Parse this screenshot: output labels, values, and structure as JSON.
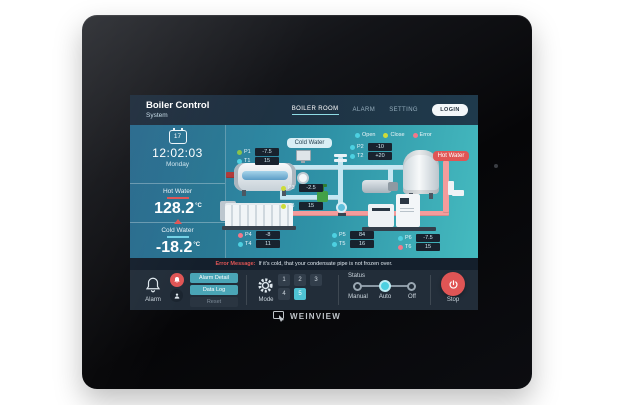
{
  "brand": {
    "logo_text": "WEINVIEW"
  },
  "header": {
    "title": "Boiler Control",
    "subtitle": "System",
    "nav": [
      {
        "label": "BOILER ROOM"
      },
      {
        "label": "ALARM"
      },
      {
        "label": "SETTING"
      }
    ],
    "login_label": "LOGIN"
  },
  "sidebar": {
    "calendar_day": "17",
    "time": "12:02:03",
    "weekday": "Monday",
    "hot_water": {
      "label": "Hot Water",
      "value": "128.2",
      "unit": "°C"
    },
    "cold_water": {
      "label": "Cold Water",
      "value": "-18.2",
      "unit": "°C"
    }
  },
  "diagram": {
    "legend": [
      {
        "label": "Open",
        "color": "#4dd0e1"
      },
      {
        "label": "Close",
        "color": "#cddc39"
      },
      {
        "label": "Error",
        "color": "#f2788a"
      }
    ],
    "pipe_labels": {
      "cold": "Cold Water",
      "hot": "Hot Water"
    },
    "sensors": [
      {
        "id": "P1",
        "value": "-7.5",
        "color": "#8bc34a"
      },
      {
        "id": "T1",
        "value": "15",
        "color": "#4dd0e1"
      },
      {
        "id": "P2",
        "value": "-10",
        "color": "#4dd0e1"
      },
      {
        "id": "T2",
        "value": "+20",
        "color": "#4dd0e1"
      },
      {
        "id": "P3",
        "value": "-2.5",
        "color": "#cddc39"
      },
      {
        "id": "T3",
        "value": "15",
        "color": "#cddc39"
      },
      {
        "id": "P4",
        "value": "-8",
        "color": "#f2788a"
      },
      {
        "id": "T4",
        "value": "11",
        "color": "#4dd0e1"
      },
      {
        "id": "P5",
        "value": "84",
        "color": "#4dd0e1"
      },
      {
        "id": "T5",
        "value": "16",
        "color": "#4dd0e1"
      },
      {
        "id": "P6",
        "value": "-7.5",
        "color": "#4dd0e1"
      },
      {
        "id": "T6",
        "value": "15",
        "color": "#f2788a"
      }
    ]
  },
  "error_bar": {
    "label": "Error Message:",
    "text": "If it's cold, that your condensate pipe is not frozen over."
  },
  "control_bar": {
    "alarm": {
      "label": "Alarm",
      "buttons": [
        {
          "label": "Alarm Detail"
        },
        {
          "label": "Data Log"
        },
        {
          "label": "Reset"
        }
      ]
    },
    "mode": {
      "label": "Mode",
      "options": [
        "1",
        "2",
        "3",
        "4",
        "5"
      ],
      "active": "5"
    },
    "status": {
      "label": "Status",
      "options": [
        "Manual",
        "Auto",
        "Off"
      ],
      "active": "Auto"
    },
    "stop": {
      "label": "Stop"
    }
  },
  "colors": {
    "accent_cyan": "#4fc3d4",
    "button_teal": "#4aa5b6",
    "alert_red": "#e05555",
    "hot_pipe": "#f49c9c",
    "cold_pipe": "#c6e7f2"
  }
}
